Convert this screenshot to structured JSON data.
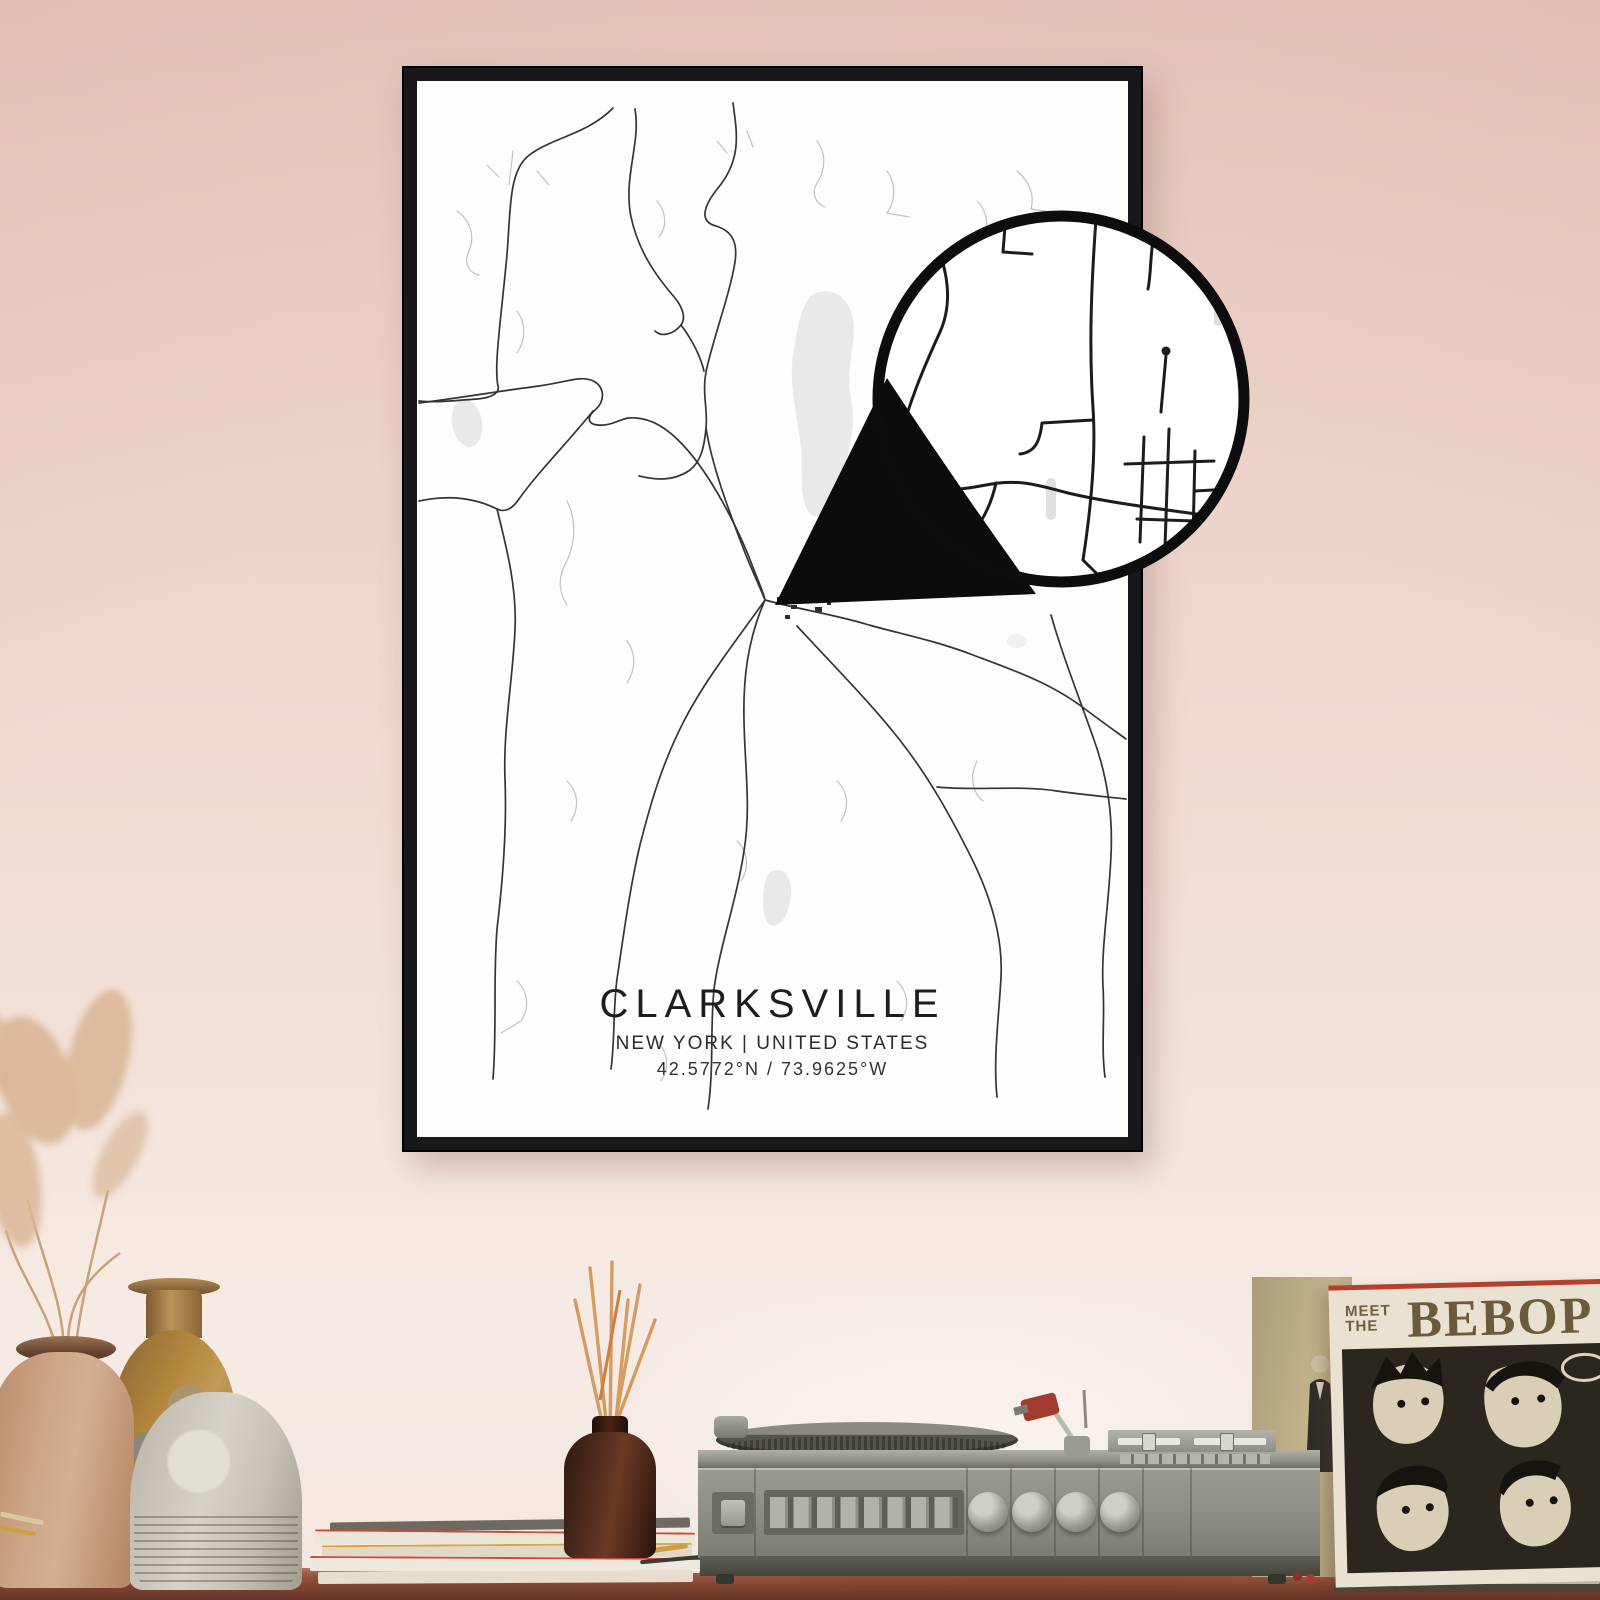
{
  "poster": {
    "title": "CLARKSVILLE",
    "subtitle": "NEW YORK | UNITED STATES",
    "coordinates": "42.5772°N / 73.9625°W"
  },
  "album": {
    "title_line1": "MEET",
    "title_line2": "THE",
    "title_main": "BEBOP"
  },
  "icons": {
    "magnifier": "zoom-detail-circle-icon",
    "pointer": "zoom-pointer-wedge-icon"
  },
  "colors": {
    "wall_top": "#e7c9bf",
    "wall_bottom": "#f5ebe4",
    "frame": "#17181a",
    "poster_background": "#fdfdfc",
    "road_dark": "#343434",
    "road_light": "#c2c2c2",
    "water": "#e9e9e9",
    "magnifier_ink": "#0d0d0d",
    "table_wood": "#8a4a33",
    "player_body": "#8c8c84",
    "album_cream": "#e9e2d2",
    "album_ink": "#6a5b3d",
    "album_accent_red": "#b5402e",
    "vase_tan": "#cda587",
    "vase_ochre": "#b5883e",
    "vase_ribbed": "#d7d2c8",
    "diffuser_brown": "#5d3322",
    "reed_tan": "#d49c62"
  }
}
